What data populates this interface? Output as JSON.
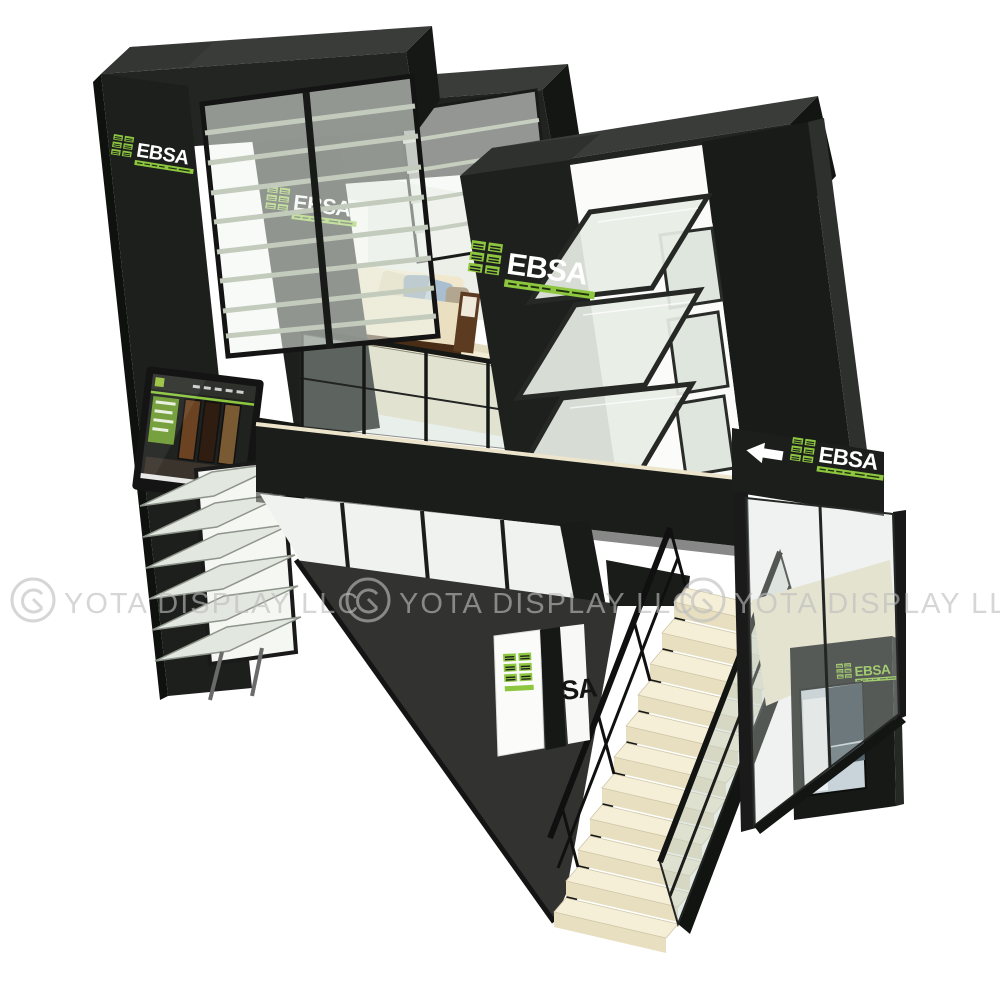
{
  "scene": {
    "type": "3d-product-render",
    "subject": "double-deck exhibition trade show booth with staircase, louvre window displays, lounge and TV screen",
    "background_color": "#ffffff",
    "elements": [
      "left-tower",
      "middle-tower",
      "right-tower",
      "louvre-windows",
      "awning-window-displays",
      "upper-deck-lounge",
      "sofa",
      "tv-screen",
      "glass-balustrade",
      "floor-fascia",
      "direction-sign",
      "staircase",
      "handrails",
      "carpet",
      "ground-glass-walls",
      "display-kiosk",
      "poster",
      "ebsa-column"
    ]
  },
  "brand": {
    "name": "EBSA",
    "green": "#8dc63f"
  },
  "logos": {
    "tower_left": "EBSA",
    "tower_middle": "EBSA",
    "tower_right": "EBSA",
    "direction_sign": "EBSA",
    "kiosk": "EBSA",
    "ground_column_visible": "SA"
  },
  "direction_sign": {
    "arrow": "left"
  },
  "watermark": {
    "text": "YOTA DISPLAY LLC",
    "instances": 3,
    "color": "#bdbdbd",
    "mark": "yota-circle-logo"
  },
  "palette": {
    "frame_black": "#1e201e",
    "frame_top": "#3a3c3a",
    "glass_tint": "#e7ede3",
    "floor_cream": "#f2ecd4",
    "stair_tread": "#f5efd8",
    "carpet_dark": "#3a3a38",
    "wood_brown": "#5d3b21",
    "sofa_cream": "#eadfc1",
    "pillow_blue": "#8099ad"
  }
}
